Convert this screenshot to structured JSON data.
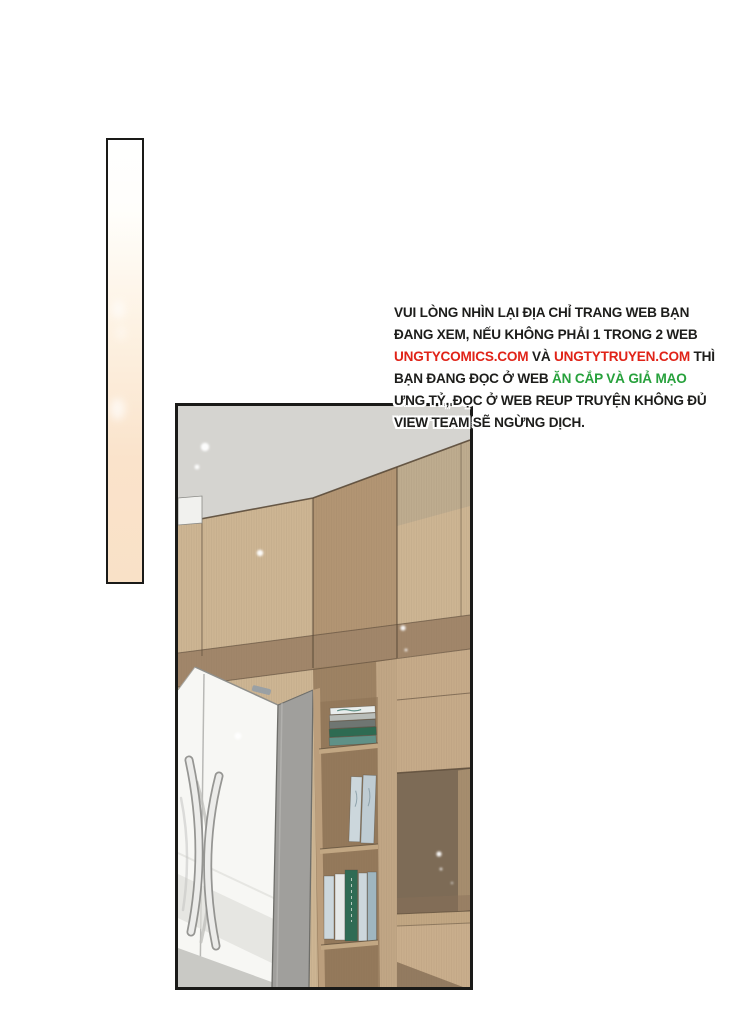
{
  "notice": {
    "lines": [
      {
        "segments": [
          {
            "text": "VUI LÒNG NHÌN LẠI ĐỊA CHỈ TRANG WEB BẠN",
            "color": "black"
          }
        ]
      },
      {
        "segments": [
          {
            "text": "ĐANG XEM, NẾU KHÔNG PHẢI 1 TRONG 2 WEB",
            "color": "black"
          }
        ]
      },
      {
        "segments": [
          {
            "text": "UNGTYCOMICS.COM",
            "color": "red"
          },
          {
            "text": " VÀ ",
            "color": "black"
          },
          {
            "text": "UNGTYTRUYEN.COM",
            "color": "red"
          },
          {
            "text": " THÌ",
            "color": "black"
          }
        ]
      },
      {
        "segments": [
          {
            "text": "BẠN ĐANG ĐỌC Ở WEB ",
            "color": "black"
          },
          {
            "text": "ĂN CẮP VÀ GIẢ MẠO",
            "color": "green"
          }
        ]
      },
      {
        "segments": [
          {
            "text": "ƯNG TỶ, ĐỌC Ở WEB REUP TRUYỆN KHÔNG ĐỦ",
            "color": "black"
          }
        ]
      },
      {
        "segments": [
          {
            "text": "VIEW TEAM SẼ NGỪNG DỊCH.",
            "color": "black"
          }
        ]
      }
    ],
    "colors": {
      "black": "#1d1d1b",
      "red": "#e02318",
      "green": "#27a13c",
      "outline": "#ffffff"
    }
  },
  "palette": {
    "panel_border": "#1a1a18",
    "panel_peach": "#fae3cb",
    "ceiling": "#d5d4d0",
    "wood": "#cdb593",
    "wood_shade": "#b3a48c",
    "wood_mid": "#b29573",
    "wood_dark": "#a1866a",
    "wood_face": "#c6ab89",
    "wood_face2": "#c9ae8c",
    "wood_board": "#c2a783",
    "wedge": "#8a7258",
    "shelf": "#9d8263",
    "shelf_recess": "#8d7356",
    "shelf_light": "#bb9e7c",
    "shelf_frame": "#c1a685",
    "compartment": "#7d6b56",
    "compartment_wall": "#ab9171",
    "column": "#a09f9c",
    "fridge": "#f7f7f4",
    "fridge_line": "#b9b9b6",
    "fridge_shadow": "#ddddd9",
    "fridge_shadow2": "#c9c9c5",
    "handle": "#ececea",
    "handle_edge": "#8b8b88",
    "handle_shadow": "#c0c0bd",
    "label": "#9aa0a4",
    "line_dark": "#5a4a38",
    "grain": "#7a6450",
    "sparkle": "#ffffff",
    "book_white": "#e9edec",
    "book_gray": "#b9bdb9",
    "book_dgray": "#6f7672",
    "book_green": "#2e6b52",
    "book_teal": "#5f9187",
    "book_pale": "#ccd7dc",
    "book_pale2": "#bfccd3",
    "book_white2": "#e6e9e8",
    "book_green2": "#2f6b54",
    "book_blue": "#9fb6c0"
  }
}
